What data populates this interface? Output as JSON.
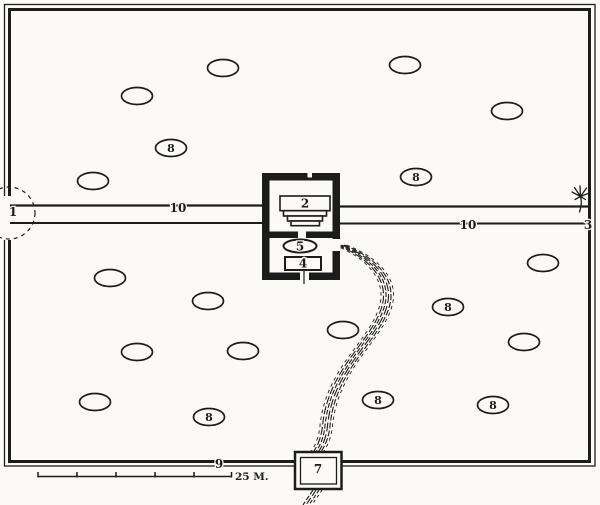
{
  "figure": {
    "type": "engraved-site-plan",
    "description_visible_text_only": true
  },
  "colors": {
    "paper": "#fbfaf7",
    "ink": "#1c1c1c"
  },
  "labels": {
    "entrance_left": "1",
    "platform": "2",
    "tree_gate": "3",
    "tank": "4",
    "basin": "5",
    "gatehouse": "7",
    "wall": "9",
    "avenue_left": "10",
    "avenue_right": "10"
  },
  "scale_bar": {
    "label": "25 M.",
    "segments": 5
  },
  "beds": {
    "label": "8",
    "items": [
      {
        "cx": 223,
        "cy": 68,
        "labeled": false
      },
      {
        "cx": 405,
        "cy": 65,
        "labeled": false
      },
      {
        "cx": 137,
        "cy": 96,
        "labeled": false
      },
      {
        "cx": 507,
        "cy": 111,
        "labeled": false
      },
      {
        "cx": 171,
        "cy": 148,
        "labeled": true
      },
      {
        "cx": 93,
        "cy": 181,
        "labeled": false
      },
      {
        "cx": 416,
        "cy": 177,
        "labeled": true
      },
      {
        "cx": 110,
        "cy": 278,
        "labeled": false
      },
      {
        "cx": 208,
        "cy": 301,
        "labeled": false
      },
      {
        "cx": 543,
        "cy": 263,
        "labeled": false
      },
      {
        "cx": 137,
        "cy": 352,
        "labeled": false
      },
      {
        "cx": 243,
        "cy": 351,
        "labeled": false
      },
      {
        "cx": 448,
        "cy": 307,
        "labeled": true
      },
      {
        "cx": 343,
        "cy": 330,
        "labeled": false
      },
      {
        "cx": 524,
        "cy": 342,
        "labeled": false
      },
      {
        "cx": 95,
        "cy": 402,
        "labeled": false
      },
      {
        "cx": 209,
        "cy": 417,
        "labeled": true
      },
      {
        "cx": 378,
        "cy": 400,
        "labeled": true
      },
      {
        "cx": 493,
        "cy": 405,
        "labeled": true
      }
    ]
  }
}
